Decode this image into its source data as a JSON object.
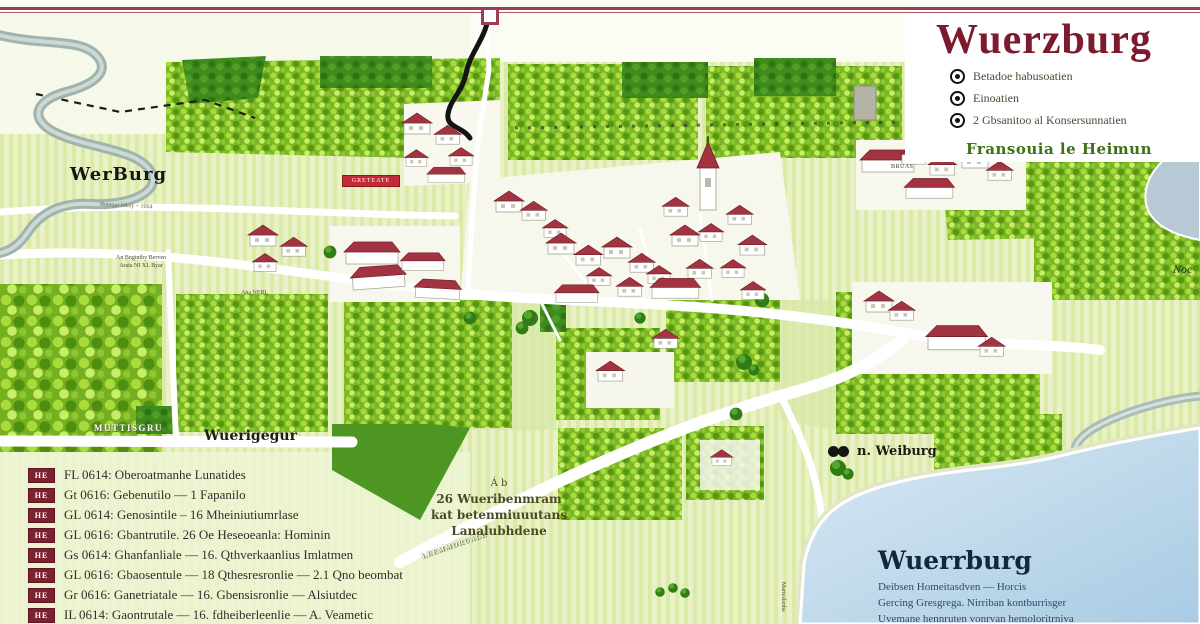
{
  "title_block": {
    "title": "Wuerzburg",
    "items": [
      {
        "label": "Betadoe habusoatien"
      },
      {
        "label": "Einoatien"
      },
      {
        "label": "2 Gbsanitoo al Konsersunnatien"
      }
    ],
    "subtitle": "Fransouia le Heimun"
  },
  "map": {
    "region_label": "WerBurg",
    "vineyard_label": "Wuerigegur",
    "road_band_label": "MUTTISGRU",
    "road_label_1": "Ana NERL",
    "road_label_2": "Botequr lekuy ~ 1664",
    "road_label_3": "LEEMMORUALE",
    "field_note_1": "An Bngtnthy Berven",
    "field_note_2": "Arata NI XL Byar",
    "banner_label": "GRETEATE",
    "building_label": "BRUAS",
    "edge_label": "Noc",
    "poi_label": "n. Weiburg",
    "vertical_label": "Marteslenba"
  },
  "center_note": {
    "line1": "Á b",
    "line2": "26 Wueribenmram",
    "line3": "kat betenmiuuutans",
    "line4": "Lanalubhdene"
  },
  "lake_block": {
    "title": "Wuerrburg",
    "line1": "Deibsen Homeitasdven — Horcis",
    "line2": "Gercing Gresgrega. Nirriban kontburrisger",
    "line3": "Uvemane hennruten vonrvan hemoloritrniva"
  },
  "legend": {
    "rows": [
      {
        "badge": "HE",
        "text": "FL 0614: Oberoatmanhe Lunatides"
      },
      {
        "badge": "HE",
        "text": "Gt 0616: Gebenutilo — 1 Fapanilo"
      },
      {
        "badge": "HE",
        "text": "GL 0614: Genosintile – 16 Mheiniutiumrlase"
      },
      {
        "badge": "HE",
        "text": "GL 0616: Gbantrutile. 26 Oe Heseoeanla: Hominin"
      },
      {
        "badge": "HE",
        "text": "Gs 0614: Ghanfanliale — 16. Qthverkaanlius Imlatmen"
      },
      {
        "badge": "HE",
        "text": "GL 0616: Gbaosentule — 18 Qthesresronlie — 2.1 Qno beombat"
      },
      {
        "badge": "HE",
        "text": "Gr 0616: Ganetriatale — 16. Gbensisronlie — Alsiutdec"
      },
      {
        "badge": "HE",
        "text": "IL 0614: Gaontrutale — 16. fdheiberleenlie — A. Veametic"
      }
    ]
  },
  "colors": {
    "accent_maroon": "#7d1b2e",
    "badge_maroon": "#7c2130",
    "vineyard_green": "#7db625",
    "forest_green": "#3d8a1c",
    "lake_blue": "#bcd8ea",
    "roof_red": "#a23441"
  }
}
